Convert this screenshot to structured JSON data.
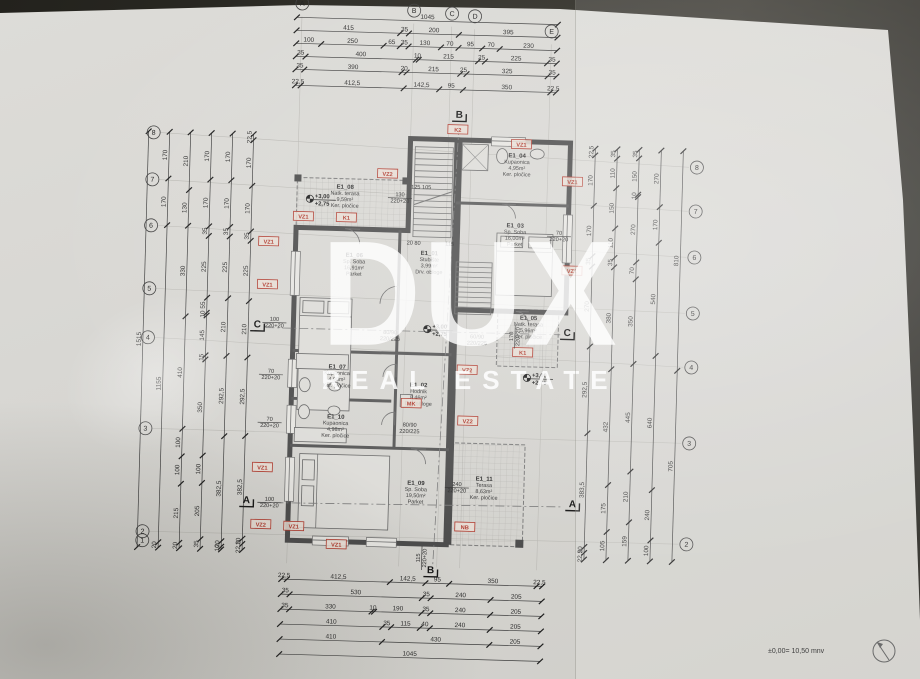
{
  "watermark": {
    "title": "DUX",
    "subtitle": "REAL ESTATE"
  },
  "footer": {
    "datum_note": "±0,00= 10,50 mnv"
  },
  "grid": {
    "cols": [
      {
        "label": "A",
        "x": 293,
        "y": 8
      },
      {
        "label": "B",
        "x": 405,
        "y": 12
      },
      {
        "label": "C",
        "x": 443,
        "y": 14
      },
      {
        "label": "D",
        "x": 466,
        "y": 16
      },
      {
        "label": "E",
        "x": 543,
        "y": 29
      }
    ],
    "rows": [
      {
        "label": "8",
        "yl": 141,
        "yr": 161
      },
      {
        "label": "7",
        "yl": 188,
        "yr": 205
      },
      {
        "label": "6",
        "yl": 234,
        "yr": 251
      },
      {
        "label": "5",
        "yl": 297,
        "yr": 307
      },
      {
        "label": "4",
        "yl": 346,
        "yr": 361
      },
      {
        "label": "3",
        "yl": 437,
        "yr": 437
      },
      {
        "label": "2",
        "yl": 540,
        "yr": 538
      },
      {
        "label": "1",
        "yl": 549,
        "yr": null
      }
    ]
  },
  "sections": [
    {
      "label": "B",
      "x": 453,
      "y": 118
    },
    {
      "label": "B",
      "x": 437,
      "y": 574
    },
    {
      "label": "A",
      "x": 251,
      "y": 509
    },
    {
      "label": "A",
      "x": 577,
      "y": 504
    },
    {
      "label": "C",
      "x": 257,
      "y": 333
    },
    {
      "label": "C",
      "x": 567,
      "y": 333
    }
  ],
  "rooms": [
    {
      "id": "E1_08",
      "name": "Natk. terasa",
      "area": "9,59m²",
      "finish": "Ker. pločice",
      "x": 341,
      "y": 192
    },
    {
      "id": "E1_06",
      "name": "Sp. Soba",
      "area": "16,91m²",
      "finish": "Parket",
      "x": 352,
      "y": 260
    },
    {
      "id": "E1_01",
      "name": "Stubište",
      "area": "3,99m²",
      "finish": "Drv. obloge",
      "x": 427,
      "y": 256
    },
    {
      "id": "E1_04",
      "name": "Kupaonica",
      "area": "4,95m²",
      "finish": "Ker. pločice",
      "x": 512,
      "y": 156
    },
    {
      "id": "E1_03",
      "name": "Sp. Soba",
      "area": "16,00m²",
      "finish": "Parket",
      "x": 512,
      "y": 226
    },
    {
      "id": "E1_05",
      "name": "Natk. terasa",
      "area": "5,96m²",
      "finish": "Ker. pločice",
      "x": 528,
      "y": 318
    },
    {
      "id": "E1_07",
      "name": "Kupaonica",
      "area": "4,98m²",
      "finish": "Ker. pločice",
      "x": 338,
      "y": 372
    },
    {
      "id": "E1_02",
      "name": "Hodnik",
      "area": "8,46m²",
      "finish": "Drv. obloge",
      "x": 420,
      "y": 388
    },
    {
      "id": "E1_10",
      "name": "Kupaonica",
      "area": "4,98m²",
      "finish": "Ker. pločice",
      "x": 338,
      "y": 422
    },
    {
      "id": "E1_09",
      "name": "Sp. Soba",
      "area": "19,50m²",
      "finish": "Parket",
      "x": 420,
      "y": 486
    },
    {
      "id": "E1_11",
      "name": "Terasa",
      "area": "8,63m²",
      "finish": "Ker. pločice",
      "x": 488,
      "y": 480
    }
  ],
  "tags": [
    {
      "label": "VZ2",
      "x": 383,
      "y": 176
    },
    {
      "label": "K2",
      "x": 452,
      "y": 130
    },
    {
      "label": "VZ1",
      "x": 516,
      "y": 143
    },
    {
      "label": "VZ1",
      "x": 568,
      "y": 179
    },
    {
      "label": "K1",
      "x": 343,
      "y": 221
    },
    {
      "label": "VZ1",
      "x": 300,
      "y": 221
    },
    {
      "label": "VZ1",
      "x": 266,
      "y": 247
    },
    {
      "label": "VZ1",
      "x": 266,
      "y": 290
    },
    {
      "label": "VZ1",
      "x": 570,
      "y": 268
    },
    {
      "label": "K1",
      "x": 523,
      "y": 351
    },
    {
      "label": "VZ2",
      "x": 468,
      "y": 370
    },
    {
      "label": "MK",
      "x": 413,
      "y": 405
    },
    {
      "label": "VZ2",
      "x": 470,
      "y": 421
    },
    {
      "label": "VZ1",
      "x": 266,
      "y": 473
    },
    {
      "label": "VZ2",
      "x": 266,
      "y": 530
    },
    {
      "label": "VZ1",
      "x": 299,
      "y": 531
    },
    {
      "label": "VZ1",
      "x": 342,
      "y": 548
    },
    {
      "label": "NB",
      "x": 470,
      "y": 527
    }
  ],
  "levels": [
    {
      "a": "+3,00",
      "b": "+2,75",
      "x": 306,
      "y": 203
    },
    {
      "a": "+3,00",
      "b": "+2,75",
      "x": 427,
      "y": 330
    },
    {
      "a": "+3,00",
      "b": "+2,75",
      "x": 528,
      "y": 376
    }
  ],
  "openings": [
    {
      "t": [
        "130",
        "220+20"
      ],
      "x": 396,
      "y": 198,
      "frac": true
    },
    {
      "t": [
        "125  105"
      ],
      "x": 417,
      "y": 190
    },
    {
      "t": [
        "20  80"
      ],
      "x": 411,
      "y": 246
    },
    {
      "t": [
        "115"
      ],
      "x": 447,
      "y": 246
    },
    {
      "t": [
        "100",
        "220+20"
      ],
      "x": 274,
      "y": 326,
      "frac": true
    },
    {
      "t": [
        "70",
        "220+20"
      ],
      "x": 272,
      "y": 378,
      "frac": true
    },
    {
      "t": [
        "70",
        "220+20"
      ],
      "x": 272,
      "y": 426,
      "frac": true
    },
    {
      "t": [
        "100",
        "220+20"
      ],
      "x": 274,
      "y": 506,
      "frac": true
    },
    {
      "t": [
        "170",
        "220+20"
      ],
      "x": 513,
      "y": 335,
      "rot": -90,
      "frac": true
    },
    {
      "t": [
        "70",
        "220+20"
      ],
      "x": 556,
      "y": 232,
      "frac": true
    },
    {
      "t": [
        "240",
        "220+20"
      ],
      "x": 461,
      "y": 486,
      "frac": true
    },
    {
      "t": [
        "80/90",
        "220/225"
      ],
      "x": 390,
      "y": 336
    },
    {
      "t": [
        "60/90",
        "220/225"
      ],
      "x": 477,
      "y": 338
    },
    {
      "t": [
        "80/90",
        "220/225"
      ],
      "x": 412,
      "y": 428
    },
    {
      "t": [
        "115",
        "220+20"
      ],
      "x": 426,
      "y": 559,
      "rot": -90,
      "frac": true
    }
  ],
  "dims": {
    "top": [
      {
        "y": 22,
        "x1": 288,
        "x2": 549,
        "values": [
          "1045"
        ]
      },
      {
        "y": 35,
        "x1": 288,
        "x2": 549,
        "values": [
          "415",
          "35",
          "200",
          "395"
        ]
      },
      {
        "y": 48,
        "x1": 288,
        "x2": 549,
        "values": [
          "100",
          "250",
          "65",
          "35",
          "130",
          "70",
          "95",
          "70",
          "230"
        ]
      },
      {
        "y": 61,
        "x1": 288,
        "x2": 549,
        "values": [
          "35",
          "400",
          "10",
          "215",
          "25",
          "225",
          "35"
        ]
      },
      {
        "y": 74,
        "x1": 288,
        "x2": 549,
        "values": [
          "35",
          "390",
          "20",
          "215",
          "25",
          "325",
          "35"
        ]
      },
      {
        "y": 90,
        "x1": 288,
        "x2": 549,
        "values": [
          "22,5",
          "412,5",
          "142,5",
          "95",
          "350",
          "22,5"
        ]
      }
    ],
    "bottom": [
      {
        "y": 584,
        "x1": 288,
        "x2": 549,
        "values": [
          "22,5",
          "412,5",
          "142,5",
          "95",
          "350",
          "22,5"
        ]
      },
      {
        "y": 599,
        "x1": 288,
        "x2": 549,
        "values": [
          "35",
          "530",
          "35",
          "240",
          "205"
        ]
      },
      {
        "y": 614,
        "x1": 288,
        "x2": 549,
        "values": [
          "35",
          "330",
          "10",
          "190",
          "35",
          "240",
          "205"
        ]
      },
      {
        "y": 629,
        "x1": 288,
        "x2": 549,
        "values": [
          "410",
          "35",
          "115",
          "40",
          "240",
          "205"
        ]
      },
      {
        "y": 644,
        "x1": 288,
        "x2": 549,
        "values": [
          "410",
          "430",
          "205"
        ]
      },
      {
        "y": 659,
        "x1": 288,
        "x2": 549,
        "values": [
          "1045"
        ]
      }
    ],
    "left": [
      {
        "x": 143,
        "y1": 140,
        "y2": 556,
        "values": [
          "1515"
        ]
      },
      {
        "x": 164,
        "y1": 140,
        "y2": 556,
        "values": [
          "170",
          "170",
          "1155",
          "20"
        ]
      },
      {
        "x": 185,
        "y1": 140,
        "y2": 556,
        "values": [
          "210",
          "130",
          "330",
          "410",
          "100",
          "100",
          "215",
          "20"
        ]
      },
      {
        "x": 206,
        "y1": 140,
        "y2": 556,
        "values": [
          "170",
          "170",
          "35",
          "225",
          "55",
          "10",
          "145",
          "15",
          "350",
          "100",
          "205",
          "35"
        ]
      },
      {
        "x": 227,
        "y1": 140,
        "y2": 556,
        "values": [
          "170",
          "170",
          "35",
          "225",
          "210",
          "292,5",
          "382,5",
          "20",
          "10"
        ]
      },
      {
        "x": 248,
        "y1": 140,
        "y2": 556,
        "values": [
          "22,5",
          "170",
          "170",
          "35",
          "225",
          "210",
          "292,5",
          "382,5",
          "20",
          "22,5"
        ]
      }
    ],
    "right": [
      {
        "x": 590,
        "y1": 145,
        "y2": 556,
        "values": [
          "22,5",
          "170",
          "170",
          "35",
          "270",
          "292,5",
          "383,5",
          "20",
          "22,5"
        ]
      },
      {
        "x": 612,
        "y1": 145,
        "y2": 556,
        "values": [
          "35",
          "110",
          "150",
          "110",
          "35",
          "380",
          "432",
          "175",
          "105"
        ]
      },
      {
        "x": 634,
        "y1": 145,
        "y2": 556,
        "values": [
          "35",
          "150",
          "10",
          "270",
          "70",
          "350",
          "445",
          "210",
          "159"
        ]
      },
      {
        "x": 656,
        "y1": 145,
        "y2": 556,
        "values": [
          "270",
          "170",
          "540",
          "640",
          "240",
          "100"
        ]
      },
      {
        "x": 678,
        "y1": 145,
        "y2": 556,
        "values": [
          "810",
          "705"
        ]
      }
    ]
  },
  "colors": {
    "paper": "#d7d6d2",
    "background": "#2a291f",
    "wall": "#4c4c4c",
    "tag_red": "#b03a2e",
    "watermark": "rgba(255,255,255,0.82)"
  }
}
